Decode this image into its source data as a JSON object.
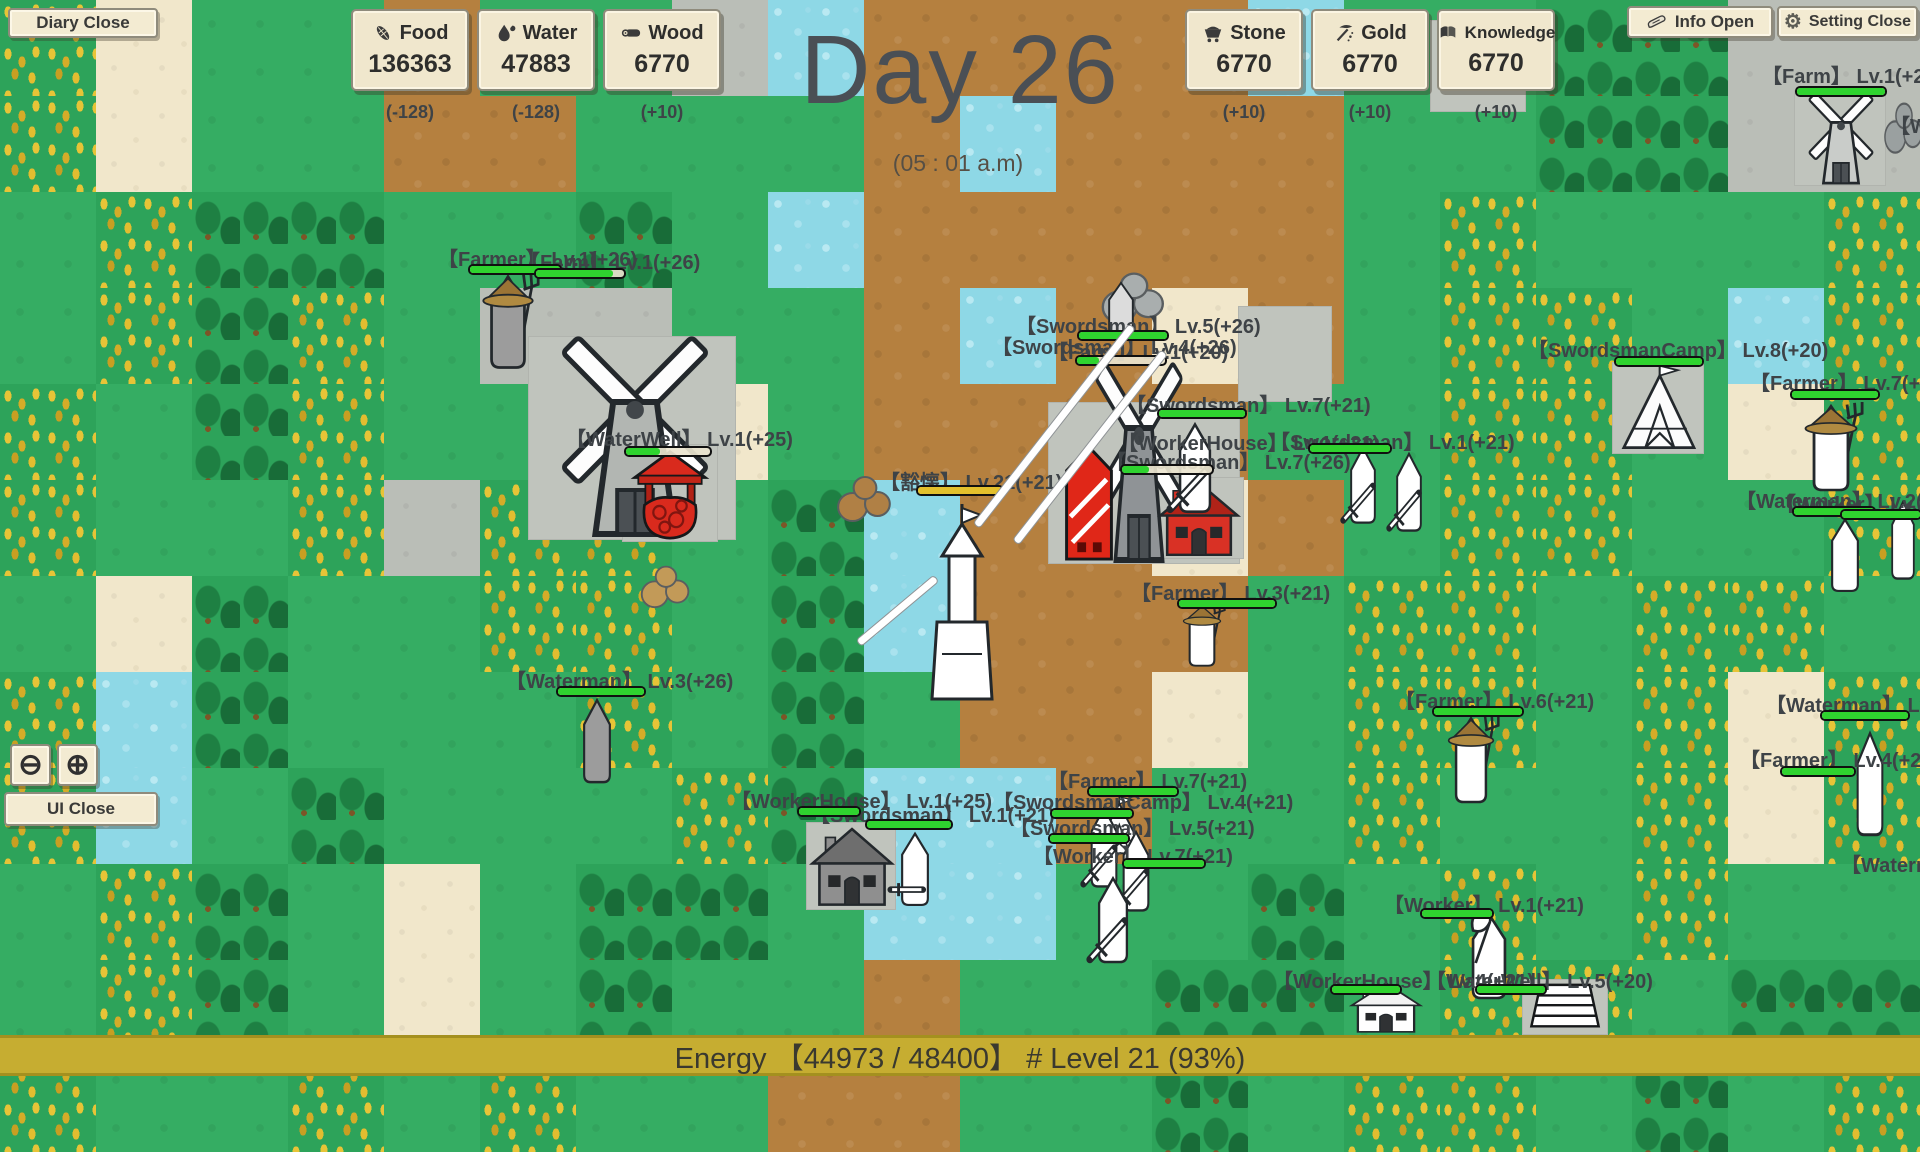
{
  "hud": {
    "diary_button": "Diary Close",
    "info_button": "Info Open",
    "setting_button": "Setting Close",
    "ui_close_button": "UI Close",
    "zoom_out_icon": "⊖",
    "zoom_in_icon": "⊕",
    "day_label": "Day 26",
    "time_label": "(05 : 01 a.m)",
    "energy_label": "Energy 【44973 / 48400】 # Level 21 (93%)"
  },
  "resources": [
    {
      "name": "Food",
      "value": "136363",
      "delta": "(-128)",
      "icon": "corn-icon",
      "side": "left"
    },
    {
      "name": "Water",
      "value": "47883",
      "delta": "(-128)",
      "icon": "water-drop-icon",
      "side": "left"
    },
    {
      "name": "Wood",
      "value": "6770",
      "delta": "(+10)",
      "icon": "log-icon",
      "side": "left"
    },
    {
      "name": "Stone",
      "value": "6770",
      "delta": "(+10)",
      "icon": "minecart-icon",
      "side": "right"
    },
    {
      "name": "Gold",
      "value": "6770",
      "delta": "(+10)",
      "icon": "pickaxe-icon",
      "side": "right"
    },
    {
      "name": "Knowledge",
      "value": "6770",
      "delta": "(+10)",
      "icon": "book-icon",
      "side": "right"
    }
  ],
  "colors": {
    "grass": "#35ad63",
    "dirt": "#b5803f",
    "sand": "#f1e7cb",
    "stone_tile": "#babeb7",
    "water": "#8ed8e6",
    "wheat_gold": "#e5c235",
    "tree_green": "#1f8746",
    "hp_green": "#2fd32f",
    "hp_yellow": "#e3c02c",
    "panel_bg": "#f0e7cd",
    "energy_bar_bg": "#c6ad31",
    "day_text": "#4a4f55"
  },
  "map": {
    "tile_size": 96,
    "tiles": {
      "g": "grass",
      "d": "dirt",
      "s": "sand",
      "r": "stone",
      "w": "water",
      "h": "wheat",
      "f": "forest"
    },
    "rows": [
      "hsggdggrwddddwggffrr",
      "hsggddgggdwdddggffrr",
      "ghffggfgwdddddghgggh",
      "ghfhgrrggdwdsdghhgwh",
      "hgfhgggsgddddgghhgsh",
      "hgghrhhgfwddsdghhggh",
      "gsfgghhgfwdddghhghhg",
      "hwfggghgfgddsghhghsh",
      "hwgfggghfwwdgghgghsh",
      "ghfgsgffgwwggfghghgg",
      "ghfgsgfggdggffghhgff",
      "hgghghggddggfghhgfgh"
    ]
  },
  "labels": [
    {
      "text": "【Farmer】 Lv.1(+26)",
      "x": 438,
      "y": 243
    },
    {
      "text": "【Farm】 Lv.1(+26)",
      "x": 520,
      "y": 246
    },
    {
      "text": "【Farm】 Lv.1(+20)",
      "x": 1762,
      "y": 60
    },
    {
      "text": "【Worker】 Lv.",
      "x": 1890,
      "y": 110
    },
    {
      "text": "【WaterWell】 Lv.1(+25)",
      "x": 566,
      "y": 423
    },
    {
      "text": "【Swordsman】 Lv.5(+26)",
      "x": 1016,
      "y": 310
    },
    {
      "text": "【Swordsman】 Lv.4(+26)",
      "x": 992,
      "y": 331
    },
    {
      "text": "【Farm】 Lv.1(+20)",
      "x": 1048,
      "y": 336
    },
    {
      "text": "【Swordsman】 Lv.7(+21)",
      "x": 1126,
      "y": 389
    },
    {
      "text": "【WorkerHouse】 Lv.1(+21)",
      "x": 1118,
      "y": 427
    },
    {
      "text": "【Swordsman】 Lv.1(+21)",
      "x": 1270,
      "y": 426
    },
    {
      "text": "【Swordsman】 Lv.7(+26)",
      "x": 1106,
      "y": 446
    },
    {
      "text": "【豁懐】 Lv.21(+21)",
      "x": 880,
      "y": 466
    },
    {
      "text": "【Farmer】 Lv.3(+21)",
      "x": 1131,
      "y": 577
    },
    {
      "text": "【Waterman】 Lv.3(+26)",
      "x": 506,
      "y": 665
    },
    {
      "text": "【WorkerHouse】 Lv.1(+25)",
      "x": 731,
      "y": 785
    },
    {
      "text": "【Swordsman】 Lv.1(+21)",
      "x": 810,
      "y": 799
    },
    {
      "text": "【Farmer】 Lv.7(+21)",
      "x": 1048,
      "y": 765
    },
    {
      "text": "【SwordsmanCamp】 Lv.4(+21)",
      "x": 993,
      "y": 786
    },
    {
      "text": "【Swordsman】 Lv.5(+21)",
      "x": 1010,
      "y": 812
    },
    {
      "text": "【Worker】 Lv.7(+21)",
      "x": 1033,
      "y": 840
    },
    {
      "text": "【SwordsmanCamp】 Lv.8(+20)",
      "x": 1528,
      "y": 334
    },
    {
      "text": "【Farmer】 Lv.7(+21)",
      "x": 1750,
      "y": 367
    },
    {
      "text": "【Waterman】 Lv.2(+20)",
      "x": 1736,
      "y": 485
    },
    {
      "text": "【Worker】 Lv.2(+21)",
      "x": 1776,
      "y": 488
    },
    {
      "text": "【Farmer】 Lv.6(+21)",
      "x": 1395,
      "y": 685
    },
    {
      "text": "【Waterman】 Lv.4(+20)",
      "x": 1766,
      "y": 689
    },
    {
      "text": "【Farmer】 Lv.4(+20)",
      "x": 1740,
      "y": 744
    },
    {
      "text": "【Waterman】 Lv.1(+20)",
      "x": 1841,
      "y": 849
    },
    {
      "text": "【Worker】 Lv.1(+21)",
      "x": 1384,
      "y": 889
    },
    {
      "text": "【WorkerHouse】 Lv.4(+21)",
      "x": 1273,
      "y": 965
    },
    {
      "text": "【WaterWell】 Lv.5(+20)",
      "x": 1426,
      "y": 965
    }
  ],
  "bars": [
    {
      "x": 468,
      "y": 264,
      "w": 90,
      "pct": 100
    },
    {
      "x": 534,
      "y": 268,
      "w": 88,
      "pct": 88
    },
    {
      "x": 1795,
      "y": 86,
      "w": 88,
      "pct": 100
    },
    {
      "x": 624,
      "y": 446,
      "w": 84,
      "pct": 40
    },
    {
      "x": 1077,
      "y": 330,
      "w": 88,
      "pct": 100
    },
    {
      "x": 1075,
      "y": 355,
      "w": 88,
      "pct": 25
    },
    {
      "x": 1157,
      "y": 408,
      "w": 86,
      "pct": 100
    },
    {
      "x": 1308,
      "y": 443,
      "w": 80,
      "pct": 100
    },
    {
      "x": 1120,
      "y": 464,
      "w": 90,
      "pct": 30
    },
    {
      "x": 916,
      "y": 485,
      "w": 84,
      "pct": 100,
      "color": "#e3c02c"
    },
    {
      "x": 1177,
      "y": 598,
      "w": 96,
      "pct": 100
    },
    {
      "x": 556,
      "y": 686,
      "w": 86,
      "pct": 100
    },
    {
      "x": 797,
      "y": 806,
      "w": 60,
      "pct": 100
    },
    {
      "x": 865,
      "y": 819,
      "w": 84,
      "pct": 100
    },
    {
      "x": 1087,
      "y": 786,
      "w": 88,
      "pct": 100
    },
    {
      "x": 1050,
      "y": 808,
      "w": 80,
      "pct": 100
    },
    {
      "x": 1048,
      "y": 833,
      "w": 78,
      "pct": 100
    },
    {
      "x": 1122,
      "y": 858,
      "w": 80,
      "pct": 100
    },
    {
      "x": 1614,
      "y": 356,
      "w": 86,
      "pct": 100
    },
    {
      "x": 1790,
      "y": 389,
      "w": 86,
      "pct": 100
    },
    {
      "x": 1792,
      "y": 506,
      "w": 80,
      "pct": 100
    },
    {
      "x": 1840,
      "y": 509,
      "w": 78,
      "pct": 100
    },
    {
      "x": 1432,
      "y": 706,
      "w": 88,
      "pct": 100
    },
    {
      "x": 1820,
      "y": 710,
      "w": 86,
      "pct": 100
    },
    {
      "x": 1780,
      "y": 766,
      "w": 72,
      "pct": 100
    },
    {
      "x": 1420,
      "y": 908,
      "w": 70,
      "pct": 100
    },
    {
      "x": 1330,
      "y": 984,
      "w": 68,
      "pct": 100
    },
    {
      "x": 1475,
      "y": 984,
      "w": 68,
      "pct": 100
    }
  ],
  "sprites": [
    {
      "type": "pad",
      "x": 528,
      "y": 336,
      "w": 208,
      "h": 204
    },
    {
      "type": "pad",
      "x": 1794,
      "y": 90,
      "w": 92,
      "h": 96
    },
    {
      "type": "pad",
      "x": 1048,
      "y": 402,
      "w": 192,
      "h": 162
    },
    {
      "type": "pad",
      "x": 622,
      "y": 444,
      "w": 96,
      "h": 98
    },
    {
      "type": "pad",
      "x": 1612,
      "y": 362,
      "w": 92,
      "h": 92
    },
    {
      "type": "pad",
      "x": 806,
      "y": 822,
      "w": 90,
      "h": 88
    },
    {
      "type": "pad",
      "x": 1156,
      "y": 477,
      "w": 88,
      "h": 82
    },
    {
      "type": "pad",
      "x": 1522,
      "y": 979,
      "w": 86,
      "h": 56
    },
    {
      "type": "pad",
      "x": 1238,
      "y": 306,
      "w": 94,
      "h": 96
    },
    {
      "type": "pad",
      "x": 1430,
      "y": 20,
      "w": 96,
      "h": 92
    },
    {
      "type": "rock",
      "x": 1098,
      "y": 268,
      "w": 72,
      "h": 58,
      "color": "#a9aeae",
      "name": "stone-pile"
    },
    {
      "type": "rock",
      "x": 834,
      "y": 472,
      "w": 62,
      "h": 52,
      "color": "#b08045",
      "name": "dirt-mound"
    },
    {
      "type": "rock",
      "x": 638,
      "y": 562,
      "w": 56,
      "h": 48,
      "color": "#c29a58",
      "name": "dirt-mound"
    },
    {
      "type": "rock",
      "x": 1882,
      "y": 98,
      "w": 44,
      "h": 58,
      "color": "#9aa0a0",
      "name": "stone-pile"
    },
    {
      "type": "windmill",
      "x": 536,
      "y": 338,
      "w": 198,
      "h": 200,
      "color": "#b2b6b2",
      "name": "farm-windmill"
    },
    {
      "type": "windmill",
      "x": 1797,
      "y": 93,
      "w": 88,
      "h": 92,
      "color": "#c9ccc9",
      "name": "farm-windmill"
    },
    {
      "type": "windmill",
      "x": 1080,
      "y": 364,
      "w": 118,
      "h": 200,
      "color": "#8f9396",
      "name": "farm-windmill"
    },
    {
      "type": "towerred",
      "x": 1050,
      "y": 444,
      "w": 78,
      "h": 118,
      "name": "red-tower"
    },
    {
      "type": "house",
      "x": 1156,
      "y": 478,
      "w": 86,
      "h": 80,
      "color": "#d93125",
      "roof": "#b02318",
      "name": "red-house"
    },
    {
      "type": "house",
      "x": 808,
      "y": 824,
      "w": 88,
      "h": 84,
      "color": "#8f8f8f",
      "roof": "#6e6e6e",
      "name": "worker-house"
    },
    {
      "type": "house",
      "x": 1348,
      "y": 980,
      "w": 76,
      "h": 54,
      "color": "#ffffff",
      "roof": "#f2f2f2",
      "name": "worker-house"
    },
    {
      "type": "tent",
      "x": 1613,
      "y": 363,
      "w": 90,
      "h": 90,
      "name": "swordsman-camp-tent"
    },
    {
      "type": "tent",
      "x": 1085,
      "y": 795,
      "w": 66,
      "h": 62,
      "name": "swordsman-camp-tent"
    },
    {
      "type": "wellred",
      "x": 626,
      "y": 448,
      "w": 88,
      "h": 92,
      "name": "water-well"
    },
    {
      "type": "wellwhite",
      "x": 1524,
      "y": 980,
      "w": 82,
      "h": 52,
      "name": "water-well"
    },
    {
      "type": "towerwhite",
      "x": 924,
      "y": 502,
      "w": 76,
      "h": 200,
      "name": "hero-tower"
    },
    {
      "type": "unit",
      "x": 476,
      "y": 272,
      "w": 64,
      "h": 102,
      "color": "#9c9c9c",
      "acc": "hat fork",
      "name": "farmer-unit"
    },
    {
      "type": "unit",
      "x": 572,
      "y": 696,
      "w": 50,
      "h": 92,
      "color": "#9c9c9c",
      "acc": "",
      "name": "waterman-unit"
    },
    {
      "type": "unit",
      "x": 1166,
      "y": 420,
      "w": 58,
      "h": 98,
      "color": "#ffffff",
      "acc": "sword",
      "name": "swordsman-unit"
    },
    {
      "type": "unit",
      "x": 1178,
      "y": 602,
      "w": 48,
      "h": 68,
      "color": "#ffffff",
      "acc": "hat fork",
      "name": "farmer-unit"
    },
    {
      "type": "unit",
      "x": 1340,
      "y": 444,
      "w": 46,
      "h": 84,
      "color": "#ffffff",
      "acc": "sword",
      "name": "swordsman-unit"
    },
    {
      "type": "unit",
      "x": 1386,
      "y": 450,
      "w": 46,
      "h": 86,
      "color": "#ffffff",
      "acc": "sword",
      "name": "swordsman-unit"
    },
    {
      "type": "unit",
      "x": 1098,
      "y": 280,
      "w": 46,
      "h": 64,
      "color": "#dcdcdc",
      "acc": "",
      "name": "unit"
    },
    {
      "type": "unit",
      "x": 1798,
      "y": 402,
      "w": 66,
      "h": 94,
      "color": "#ffffff",
      "acc": "hat fork",
      "name": "farmer-unit"
    },
    {
      "type": "unit",
      "x": 1820,
      "y": 516,
      "w": 50,
      "h": 80,
      "color": "#ffffff",
      "acc": "",
      "name": "worker-unit"
    },
    {
      "type": "unit",
      "x": 1442,
      "y": 714,
      "w": 58,
      "h": 94,
      "color": "#ffffff",
      "acc": "hat fork",
      "name": "farmer-unit"
    },
    {
      "type": "unit",
      "x": 1846,
      "y": 728,
      "w": 48,
      "h": 114,
      "color": "#ffffff",
      "acc": "",
      "name": "waterman-unit"
    },
    {
      "type": "unit",
      "x": 1458,
      "y": 910,
      "w": 62,
      "h": 94,
      "color": "#ffffff",
      "acc": "shovel",
      "name": "worker-unit"
    },
    {
      "type": "unit",
      "x": 1080,
      "y": 804,
      "w": 48,
      "h": 88,
      "color": "#ffffff",
      "acc": "sword",
      "name": "swordsman-unit"
    },
    {
      "type": "unit",
      "x": 1112,
      "y": 828,
      "w": 48,
      "h": 88,
      "color": "#ffffff",
      "acc": "sword",
      "name": "swordsman-unit"
    },
    {
      "type": "unit",
      "x": 1086,
      "y": 874,
      "w": 54,
      "h": 94,
      "color": "#ffffff",
      "acc": "sword",
      "name": "swordsman-unit"
    },
    {
      "type": "unit",
      "x": 890,
      "y": 830,
      "w": 50,
      "h": 80,
      "color": "#ffffff",
      "acc": "swordh",
      "name": "swordsman-unit"
    },
    {
      "type": "unit",
      "x": 1882,
      "y": 498,
      "w": 42,
      "h": 86,
      "color": "#ffffff",
      "acc": "",
      "name": "worker-unit"
    },
    {
      "type": "slash",
      "x": 1128,
      "y": 326,
      "len": 252,
      "rot": 38
    },
    {
      "type": "slash",
      "x": 1160,
      "y": 352,
      "len": 240,
      "rot": 38
    },
    {
      "type": "slash",
      "x": 932,
      "y": 578,
      "len": 100,
      "rot": 50
    }
  ]
}
